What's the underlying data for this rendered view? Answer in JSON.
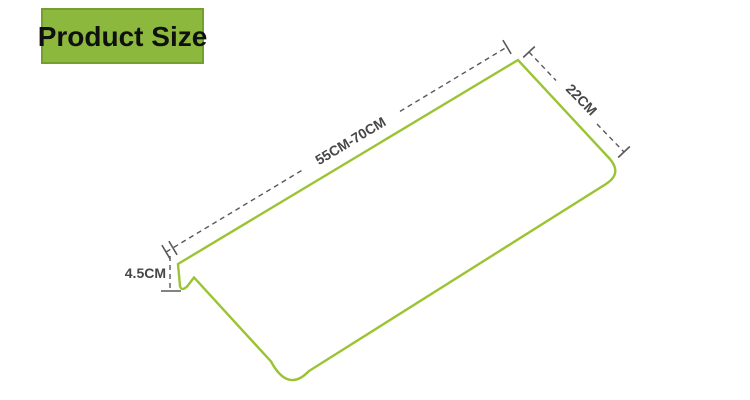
{
  "badge": {
    "label": "Product Size"
  },
  "dimensions": {
    "length": {
      "label": "55CM-70CM"
    },
    "depth": {
      "label": "22CM"
    },
    "height": {
      "label": "4.5CM"
    }
  },
  "colors": {
    "background": "#ffffff",
    "badge_bg": "#8cb83e",
    "badge_border": "#71a02f",
    "badge_text": "#101010",
    "product_outline_green": "#9cc331",
    "dimension_line_gray": "#58585a",
    "dimension_text_gray": "#464646"
  }
}
